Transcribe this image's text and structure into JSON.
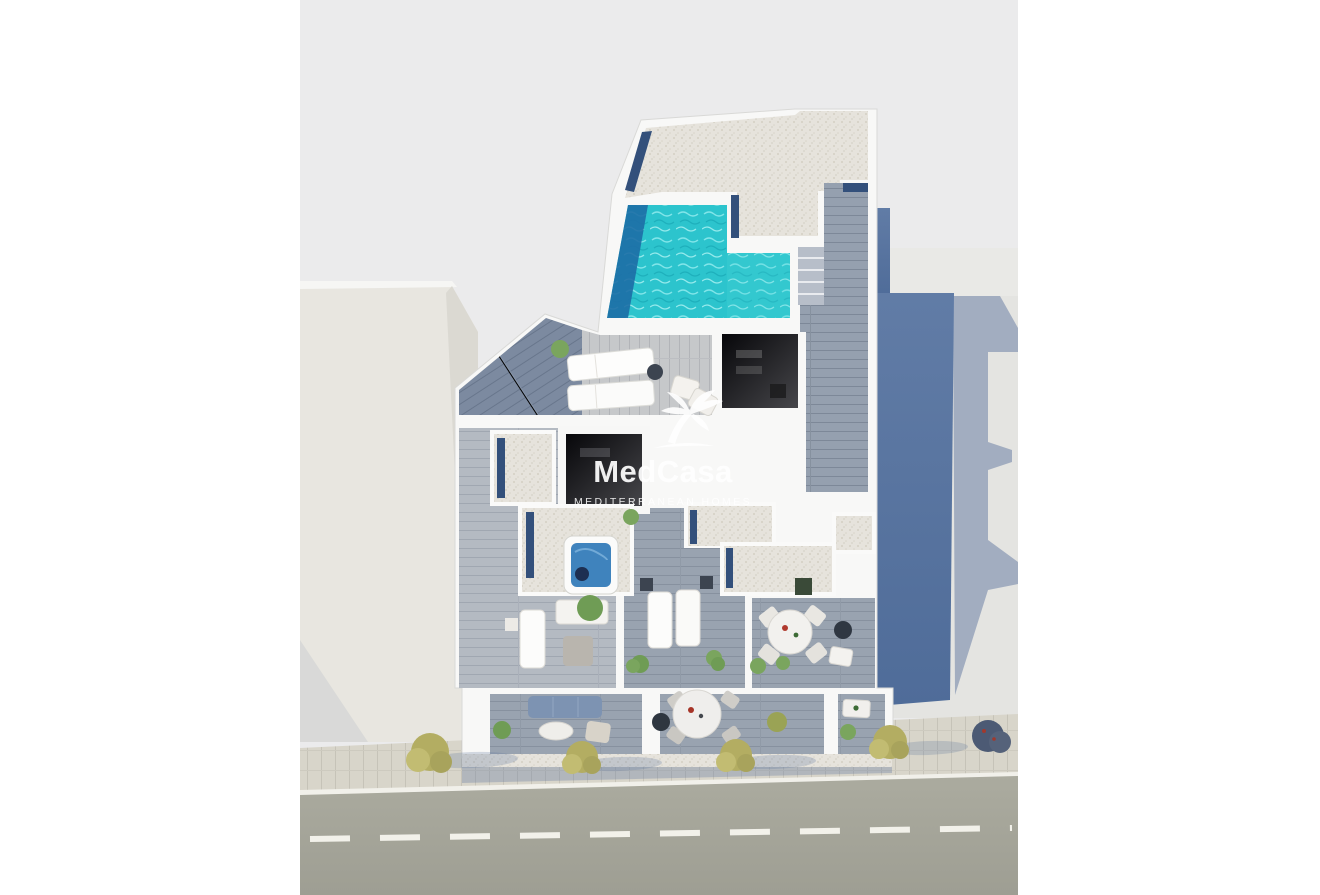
{
  "watermark": {
    "brand": "MedCasa",
    "tagline": "MEDITERRANEAN HOMES"
  },
  "palette": {
    "page_bg": "#ffffff",
    "canvas_bg": "#ebebec",
    "building_white": "#f8f8f7",
    "pool_water": "#2cc4cd",
    "pool_deep": "#1d6ea6",
    "jacuzzi_water": "#3f83bd",
    "skylight_navy": "#33507b",
    "side_wall_blue": "#5b79a6",
    "roof_gravel": "#e6e3dc",
    "deck_wood": "#95a0af",
    "terrace_wood_dark": "#7c8aa0",
    "terrace_wood_light": "#c6c8ca",
    "sidewalk": "#d8d5ca",
    "road_asphalt": "#a7a79c",
    "road_marking": "#f2f1ea",
    "tree_olive": "#b3ad62",
    "shadow_blue": "#5f76a0"
  },
  "scene": {
    "view": "aerial 3D render of rooftop floor plan",
    "features": [
      "L-shaped rooftop pool",
      "gravel roof with navy skylights",
      "timber deck with steps",
      "hot tub",
      "sun loungers",
      "outdoor dining tables",
      "street balconies with sofa and dining sets",
      "sidewalk with olive trees",
      "asphalt road with dashed centre line"
    ]
  }
}
